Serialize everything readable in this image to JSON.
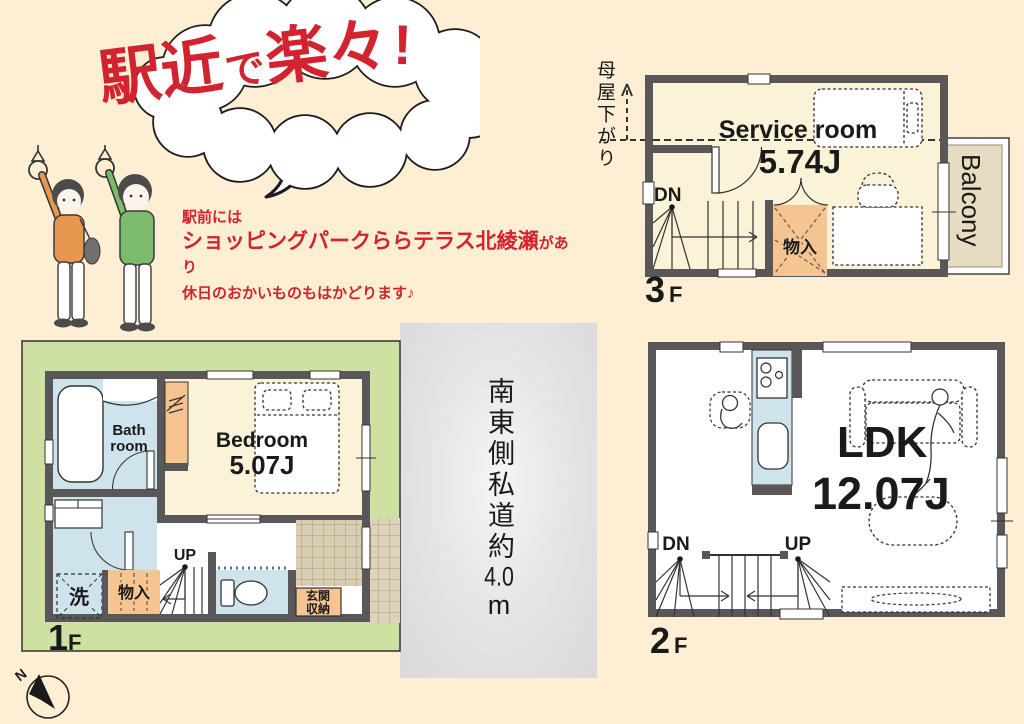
{
  "colors": {
    "background": "#fdeed4",
    "accent_red": "#d2232e",
    "wall_gray": "#595757",
    "room_cream": "#fbf3d8",
    "wet_area_blue": "#cfe3ed",
    "storage_orange": "#f6c491",
    "lot_green": "#cfe1a2",
    "road_gray": "#dcdcde",
    "tile_tan": "#d8cdb2",
    "balcony_beige": "#e5dcc1"
  },
  "bubble": {
    "title_parts": [
      "駅近",
      "で",
      "楽々",
      "!"
    ]
  },
  "intro": {
    "line1": "駅前には",
    "highlight": "ショッピングパークららテラス北綾瀬",
    "highlight_suffix": "があり",
    "line2": "休日のおかいものもはかどります♪"
  },
  "road": {
    "part1": "南東側私道約",
    "part2": "4.0",
    "part3": "m"
  },
  "compass": {
    "north": "N"
  },
  "floor3": {
    "num": "3",
    "suffix": "F",
    "eaves_note": "母屋下がり",
    "room": "Service room",
    "size": "5.74J",
    "down": "DN",
    "storage": "物入",
    "balcony": "Balcony"
  },
  "floor2": {
    "num": "2",
    "suffix": "F",
    "room": "LDK",
    "size": "12.07J",
    "down": "DN",
    "up": "UP"
  },
  "floor1": {
    "num": "1",
    "suffix": "F",
    "bath1": "Bath",
    "bath2": "room",
    "bedroom": "Bedroom",
    "size": "5.07J",
    "up": "UP",
    "washer": "洗",
    "storage": "物入",
    "entrance1": "玄関",
    "entrance2": "収納"
  }
}
